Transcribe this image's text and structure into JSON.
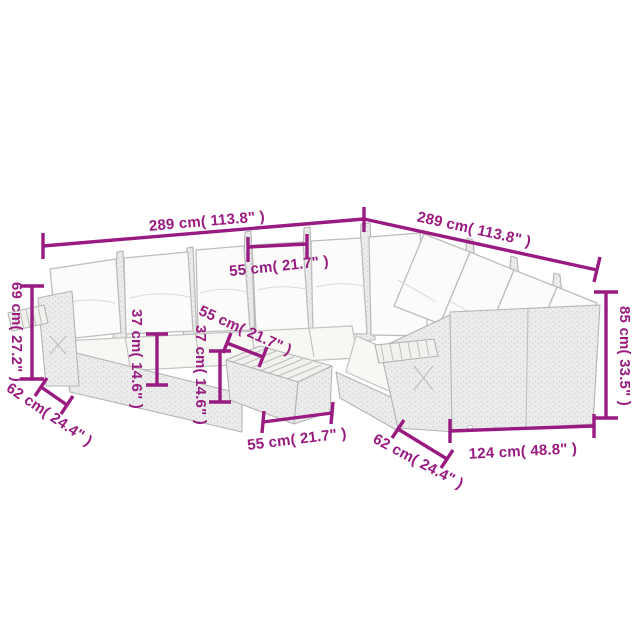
{
  "diagram": {
    "type": "furniture-dimension-diagram",
    "subject": "poly rattan corner sofa set with cushions, coffee table and bench",
    "background_color": "#ffffff",
    "dimension_color": "#991a80",
    "sketch_line_color": "#b9b9b9",
    "wicker_fill_color": "#ececec",
    "cushion_fill_color": "#fbfbf9"
  },
  "dims": {
    "back_width_left": {
      "label": "289 cm( 113.8\" )",
      "cm": 289,
      "inches": 113.8
    },
    "back_width_right": {
      "label": "289 cm( 113.8\" )",
      "cm": 289,
      "inches": 113.8
    },
    "module_width": {
      "label": "55 cm( 21.7\" )",
      "cm": 55,
      "inches": 21.7
    },
    "arm_height": {
      "label": "69 cm( 27.2\" )",
      "cm": 69,
      "inches": 27.2
    },
    "seat_height_left": {
      "label": "37 cm( 14.6\" )",
      "cm": 37,
      "inches": 14.6
    },
    "seat_height_mid": {
      "label": "37 cm( 14.6\" )",
      "cm": 37,
      "inches": 14.6
    },
    "table_depth": {
      "label": "55 cm( 21.7\" )",
      "cm": 55,
      "inches": 21.7
    },
    "seat_depth_left": {
      "label": "62 cm( 24.4\" )",
      "cm": 62,
      "inches": 24.4
    },
    "table_width": {
      "label": "55 cm( 21.7\" )",
      "cm": 55,
      "inches": 21.7
    },
    "seat_depth_right": {
      "label": "62 cm( 24.4\" )",
      "cm": 62,
      "inches": 24.4
    },
    "bench_width": {
      "label": "124 cm( 48.8\" )",
      "cm": 124,
      "inches": 48.8
    },
    "back_height_right": {
      "label": "85 cm( 33.5\" )",
      "cm": 85,
      "inches": 33.5
    }
  }
}
